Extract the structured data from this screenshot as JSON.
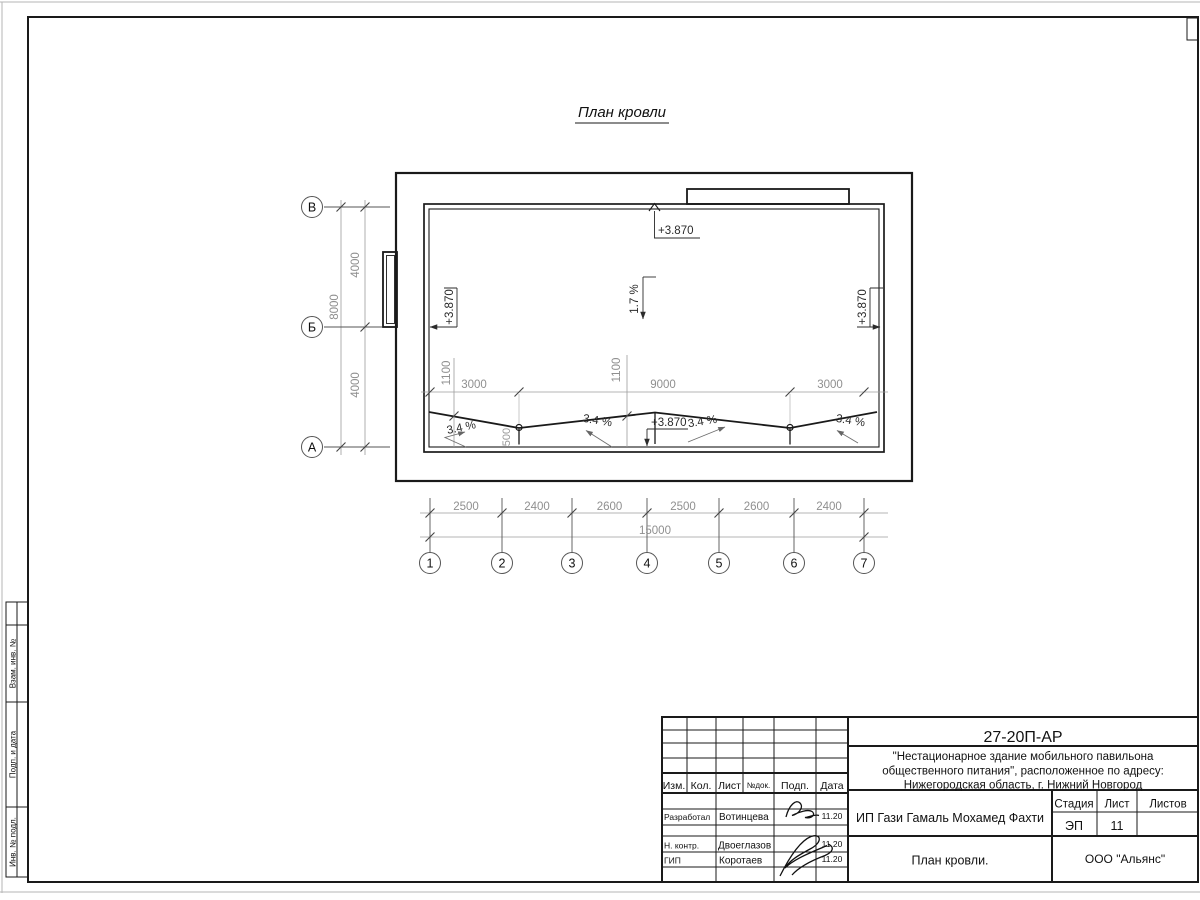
{
  "drawing": {
    "title": "План кровли",
    "elevation_mark": "+3.870",
    "slope_main": "1.7 %",
    "slope_local": "3.4 %",
    "axes_letters": [
      "В",
      "Б",
      "А"
    ],
    "axes_numbers": [
      "1",
      "2",
      "3",
      "4",
      "5",
      "6",
      "7"
    ],
    "dims": {
      "bottom_segments": [
        "2500",
        "2400",
        "2600",
        "2500",
        "2600",
        "2400"
      ],
      "bottom_total": "15000",
      "left_segments": [
        "4000",
        "4000"
      ],
      "left_total": "8000",
      "mid_segments": [
        "3000",
        "9000",
        "3000"
      ],
      "offsets": [
        "1100",
        "1100"
      ],
      "drain_offset": "500"
    }
  },
  "stamp": {
    "doc_number": "27-20П-АР",
    "project_line1": "\"Нестационарное здание мобильного павильона",
    "project_line2": "общественного питания\", расположенное по адресу:",
    "project_line3": "Нижегородская область, г. Нижний Новгород",
    "client": "ИП Гази Гамаль Мохамед Фахти",
    "sheet_caption": "План кровли.",
    "company": "ООО \"Альянс\"",
    "stage_label": "Стадия",
    "stage_value": "ЭП",
    "list_label": "Лист",
    "list_value": "11",
    "listov_label": "Листов",
    "cols": {
      "izm": "Изм.",
      "kol": "Кол.",
      "list": "Лист",
      "ndok": "№док.",
      "podp": "Подп.",
      "data": "Дата"
    },
    "rows": [
      {
        "role": "Разработал",
        "name": "Вотинцева",
        "date": "11.20"
      },
      {
        "role": "Н. контр.",
        "name": "Двоеглазов",
        "date": "11.20"
      },
      {
        "role": "ГИП",
        "name": "Коротаев",
        "date": "11.20"
      }
    ]
  },
  "frame_side_labels": [
    "Взам. инв. №",
    "Подп. и дата",
    "Инв. № подл."
  ],
  "colors": {
    "line": "#1a1a1a",
    "dim": "#8f8f8f",
    "annotation": "#2b2b2b"
  }
}
